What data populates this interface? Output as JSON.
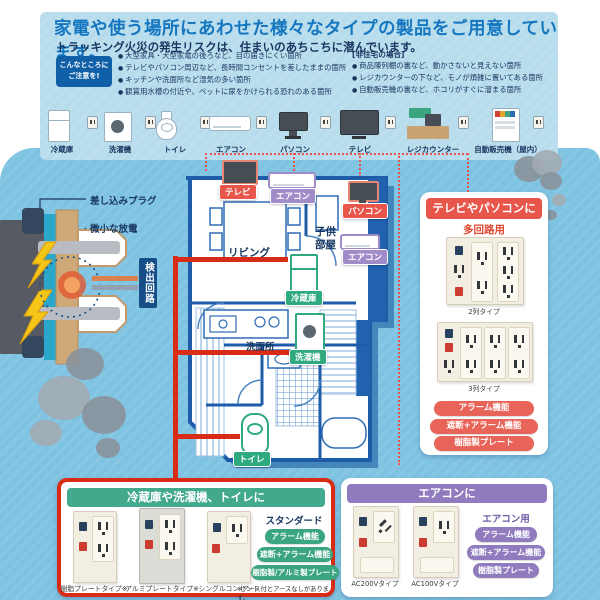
{
  "colors": {
    "accent_red": "#e0472e",
    "accent_green": "#3aa57f",
    "accent_purple": "#8f7bbe",
    "navy": "#17355f",
    "title_blue": "#1677c1"
  },
  "header": {
    "title": "家電や使う場所にあわせた様々なタイプの製品をご用意しています。",
    "subtitle": "トラッキング火災の発生リスクは、住まいのあちこちに潜んでいます。"
  },
  "attention": {
    "badge_line1": "こんなところに",
    "badge_line2": "ご注意を!",
    "home_bullets": [
      "大型家具・大型家電の後ろなど、目の届きにくい箇所",
      "テレビやパソコン周辺など、長時間コンセントを差したままの箇所",
      "キッチンや洗面所など湿気の多い箇所",
      "観賞用水槽の付近や、ペットに尿をかけられる恐れのある箇所"
    ],
    "nonres_label": "[非住宅の場合]",
    "nonres_bullets": [
      "商品陳列棚の裏など、動かさないと見えない箇所",
      "レジカウンターの下など、モノが煩雑に置いてある箇所",
      "自動販売機の裏など、ホコリがすぐに溜まる箇所"
    ]
  },
  "appliance_row": {
    "items": [
      {
        "label": "冷蔵庫"
      },
      {
        "label": "洗濯機"
      },
      {
        "label": "トイレ"
      },
      {
        "label": "エアコン"
      },
      {
        "label": "パソコン"
      },
      {
        "label": "テレビ"
      },
      {
        "label": "レジカウンター"
      },
      {
        "label": "自動販売機（屋内）"
      }
    ]
  },
  "plug_diagram": {
    "plug_label": "差し込みプラグ",
    "discharge_label": "微小な放電",
    "circuit_label": "検出回路"
  },
  "floorplan": {
    "living": "リビング",
    "kids_room": "子供部屋",
    "washroom": "洗面所",
    "markers": {
      "tv": "テレビ",
      "aircon1": "エアコン",
      "pc": "パソコン",
      "aircon2": "エアコン",
      "fridge": "冷蔵庫",
      "washer": "洗濯機",
      "toilet": "トイレ"
    }
  },
  "panel_tv": {
    "title": "テレビやパソコンに",
    "category": "多回路用",
    "products": [
      {
        "caption": "2列タイプ"
      },
      {
        "caption": "3列タイプ"
      }
    ],
    "features": [
      "アラーム機能",
      "遮断+アラーム機能",
      "樹脂製プレート"
    ]
  },
  "panel_standard": {
    "title": "冷蔵庫や洗濯機、トイレに",
    "category": "スタンダード",
    "products": [
      {
        "caption": "樹脂プレートタイプ※"
      },
      {
        "caption": "アルミプレートタイプ※"
      },
      {
        "caption": "シングルコンセント"
      }
    ],
    "features": [
      "アラーム機能",
      "遮断+アラーム機能",
      "樹脂製/アルミ製プレート"
    ],
    "footnote": "※アース付とアースなしがあります。"
  },
  "panel_aircon": {
    "title": "エアコンに",
    "category": "エアコン用",
    "products": [
      {
        "caption": "AC200Vタイプ"
      },
      {
        "caption": "AC100Vタイプ"
      }
    ],
    "features": [
      "アラーム機能",
      "遮断+アラーム機能",
      "樹脂製プレート"
    ]
  }
}
